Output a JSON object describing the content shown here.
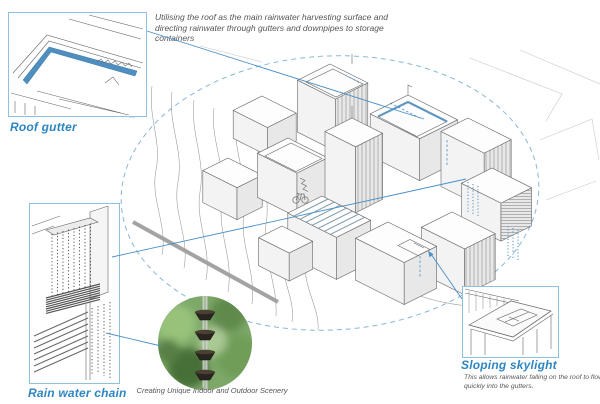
{
  "top_note": "Utilising the roof as the main rainwater harvesting surface and directing rainwater through gutters and downpipes to storage containers",
  "callouts": {
    "roof_gutter": {
      "label": "Roof gutter"
    },
    "rain_water_chain": {
      "label": "Rain water chain"
    },
    "sloping_skylight": {
      "label": "Sloping skylight",
      "description": "This allows rainwater falling on the roof to flow quickly into the gutters."
    }
  },
  "photo": {
    "caption": "Creating Unique Indoor and Outdoor Scenery"
  },
  "colors": {
    "accent": "#2e86c1",
    "leader_line": "#4a90c8",
    "callout_border": "#8fc0df",
    "gutter_blue": "#4e8fbf",
    "note_text": "#55565a",
    "drawing_line": "#666666",
    "boundary_dash": "#85b7da"
  }
}
